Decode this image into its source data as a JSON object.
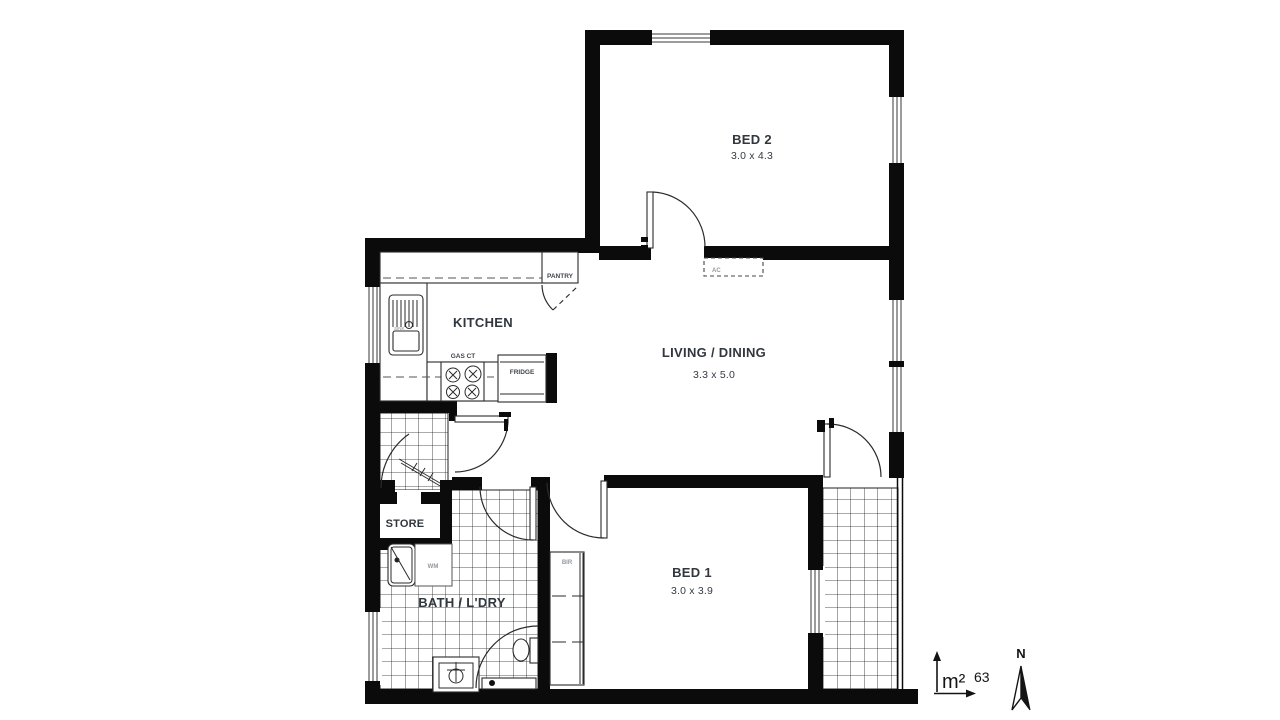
{
  "plan": {
    "rooms": {
      "bed2": {
        "name": "BED 2",
        "dims": "3.0 x 4.3"
      },
      "living": {
        "name": "LIVING / DINING",
        "dims": "3.3 x 5.0"
      },
      "bed1": {
        "name": "BED 1",
        "dims": "3.0 x 3.9"
      },
      "kitchen": {
        "name": "KITCHEN"
      },
      "store": {
        "name": "STORE"
      },
      "bath": {
        "name": "BATH / L'DRY"
      }
    },
    "fixtures": {
      "pantry": "PANTRY",
      "fridge": "FRIDGE",
      "cooktop": "GAS CT",
      "sink": "SINK",
      "washing_machine": "WM",
      "built_in_robe": "BIR",
      "air_conditioner": "AC"
    },
    "annotations": {
      "area_unit": "m²",
      "area_value": "63",
      "north": "N"
    },
    "colors": {
      "wall": "#0b0b0b",
      "line": "#2b2b2b",
      "label_dark": "#31373e",
      "label_light": "#9298a0",
      "background": "#ffffff"
    }
  }
}
